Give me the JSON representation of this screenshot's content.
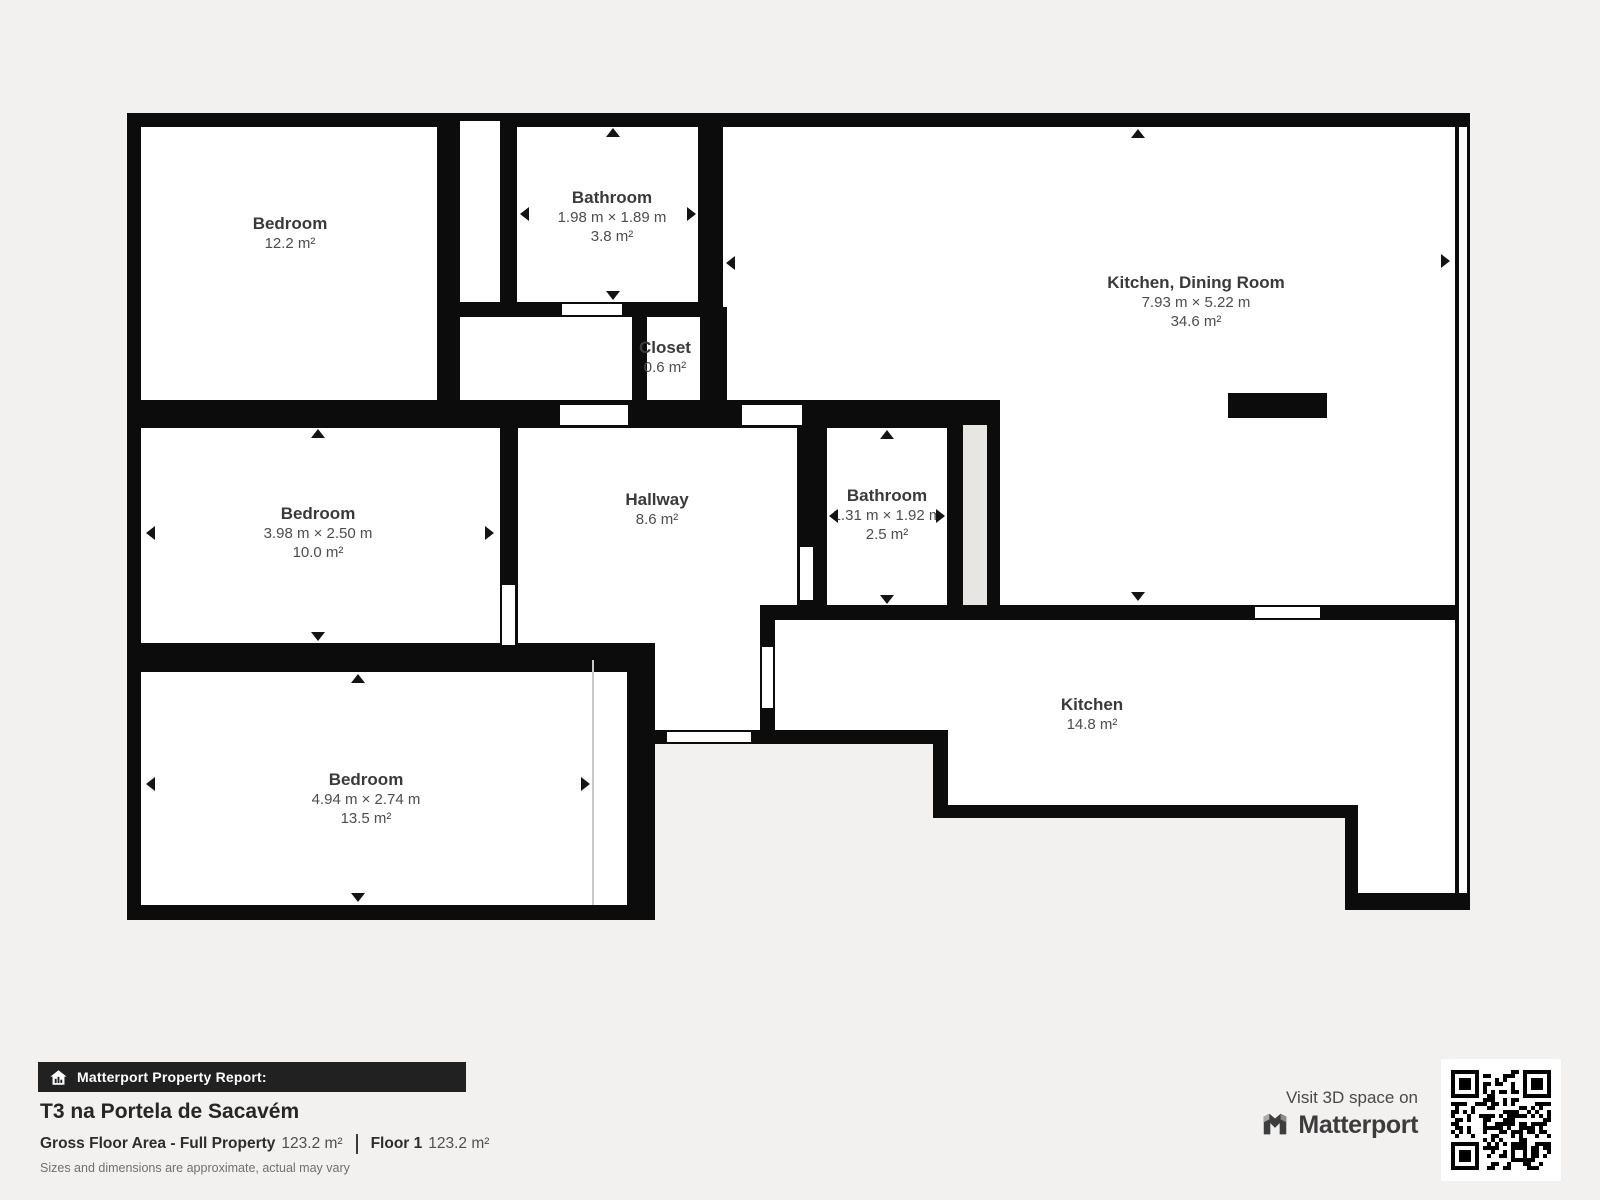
{
  "plan": {
    "rooms": {
      "bedroom1": {
        "name": "Bedroom",
        "area": "12.2 m²"
      },
      "bathroom1": {
        "name": "Bathroom",
        "dims": "1.98 m × 1.89 m",
        "area": "3.8 m²"
      },
      "kitchendining": {
        "name": "Kitchen, Dining Room",
        "dims": "7.93 m × 5.22 m",
        "area": "34.6 m²"
      },
      "closet": {
        "name": "Closet",
        "area": "0.6 m²"
      },
      "bedroom2": {
        "name": "Bedroom",
        "dims": "3.98 m × 2.50 m",
        "area": "10.0 m²"
      },
      "hallway": {
        "name": "Hallway",
        "area": "8.6 m²"
      },
      "bathroom2": {
        "name": "Bathroom",
        "dims": "1.31 m × 1.92 m",
        "area": "2.5 m²"
      },
      "kitchen": {
        "name": "Kitchen",
        "area": "14.8 m²"
      },
      "bedroom3": {
        "name": "Bedroom",
        "dims": "4.94 m × 2.74 m",
        "area": "13.5 m²"
      }
    }
  },
  "report": {
    "banner": "Matterport Property Report:",
    "title": "T3 na Portela de Sacavém",
    "gfa_label": "Gross Floor Area - Full Property",
    "gfa_value": "123.2 m²",
    "floor_label": "Floor 1",
    "floor_value": "123.2 m²",
    "disclaimer": "Sizes and dimensions are approximate, actual may vary"
  },
  "cta": {
    "visit_text": "Visit 3D space on",
    "brand": "Matterport"
  }
}
